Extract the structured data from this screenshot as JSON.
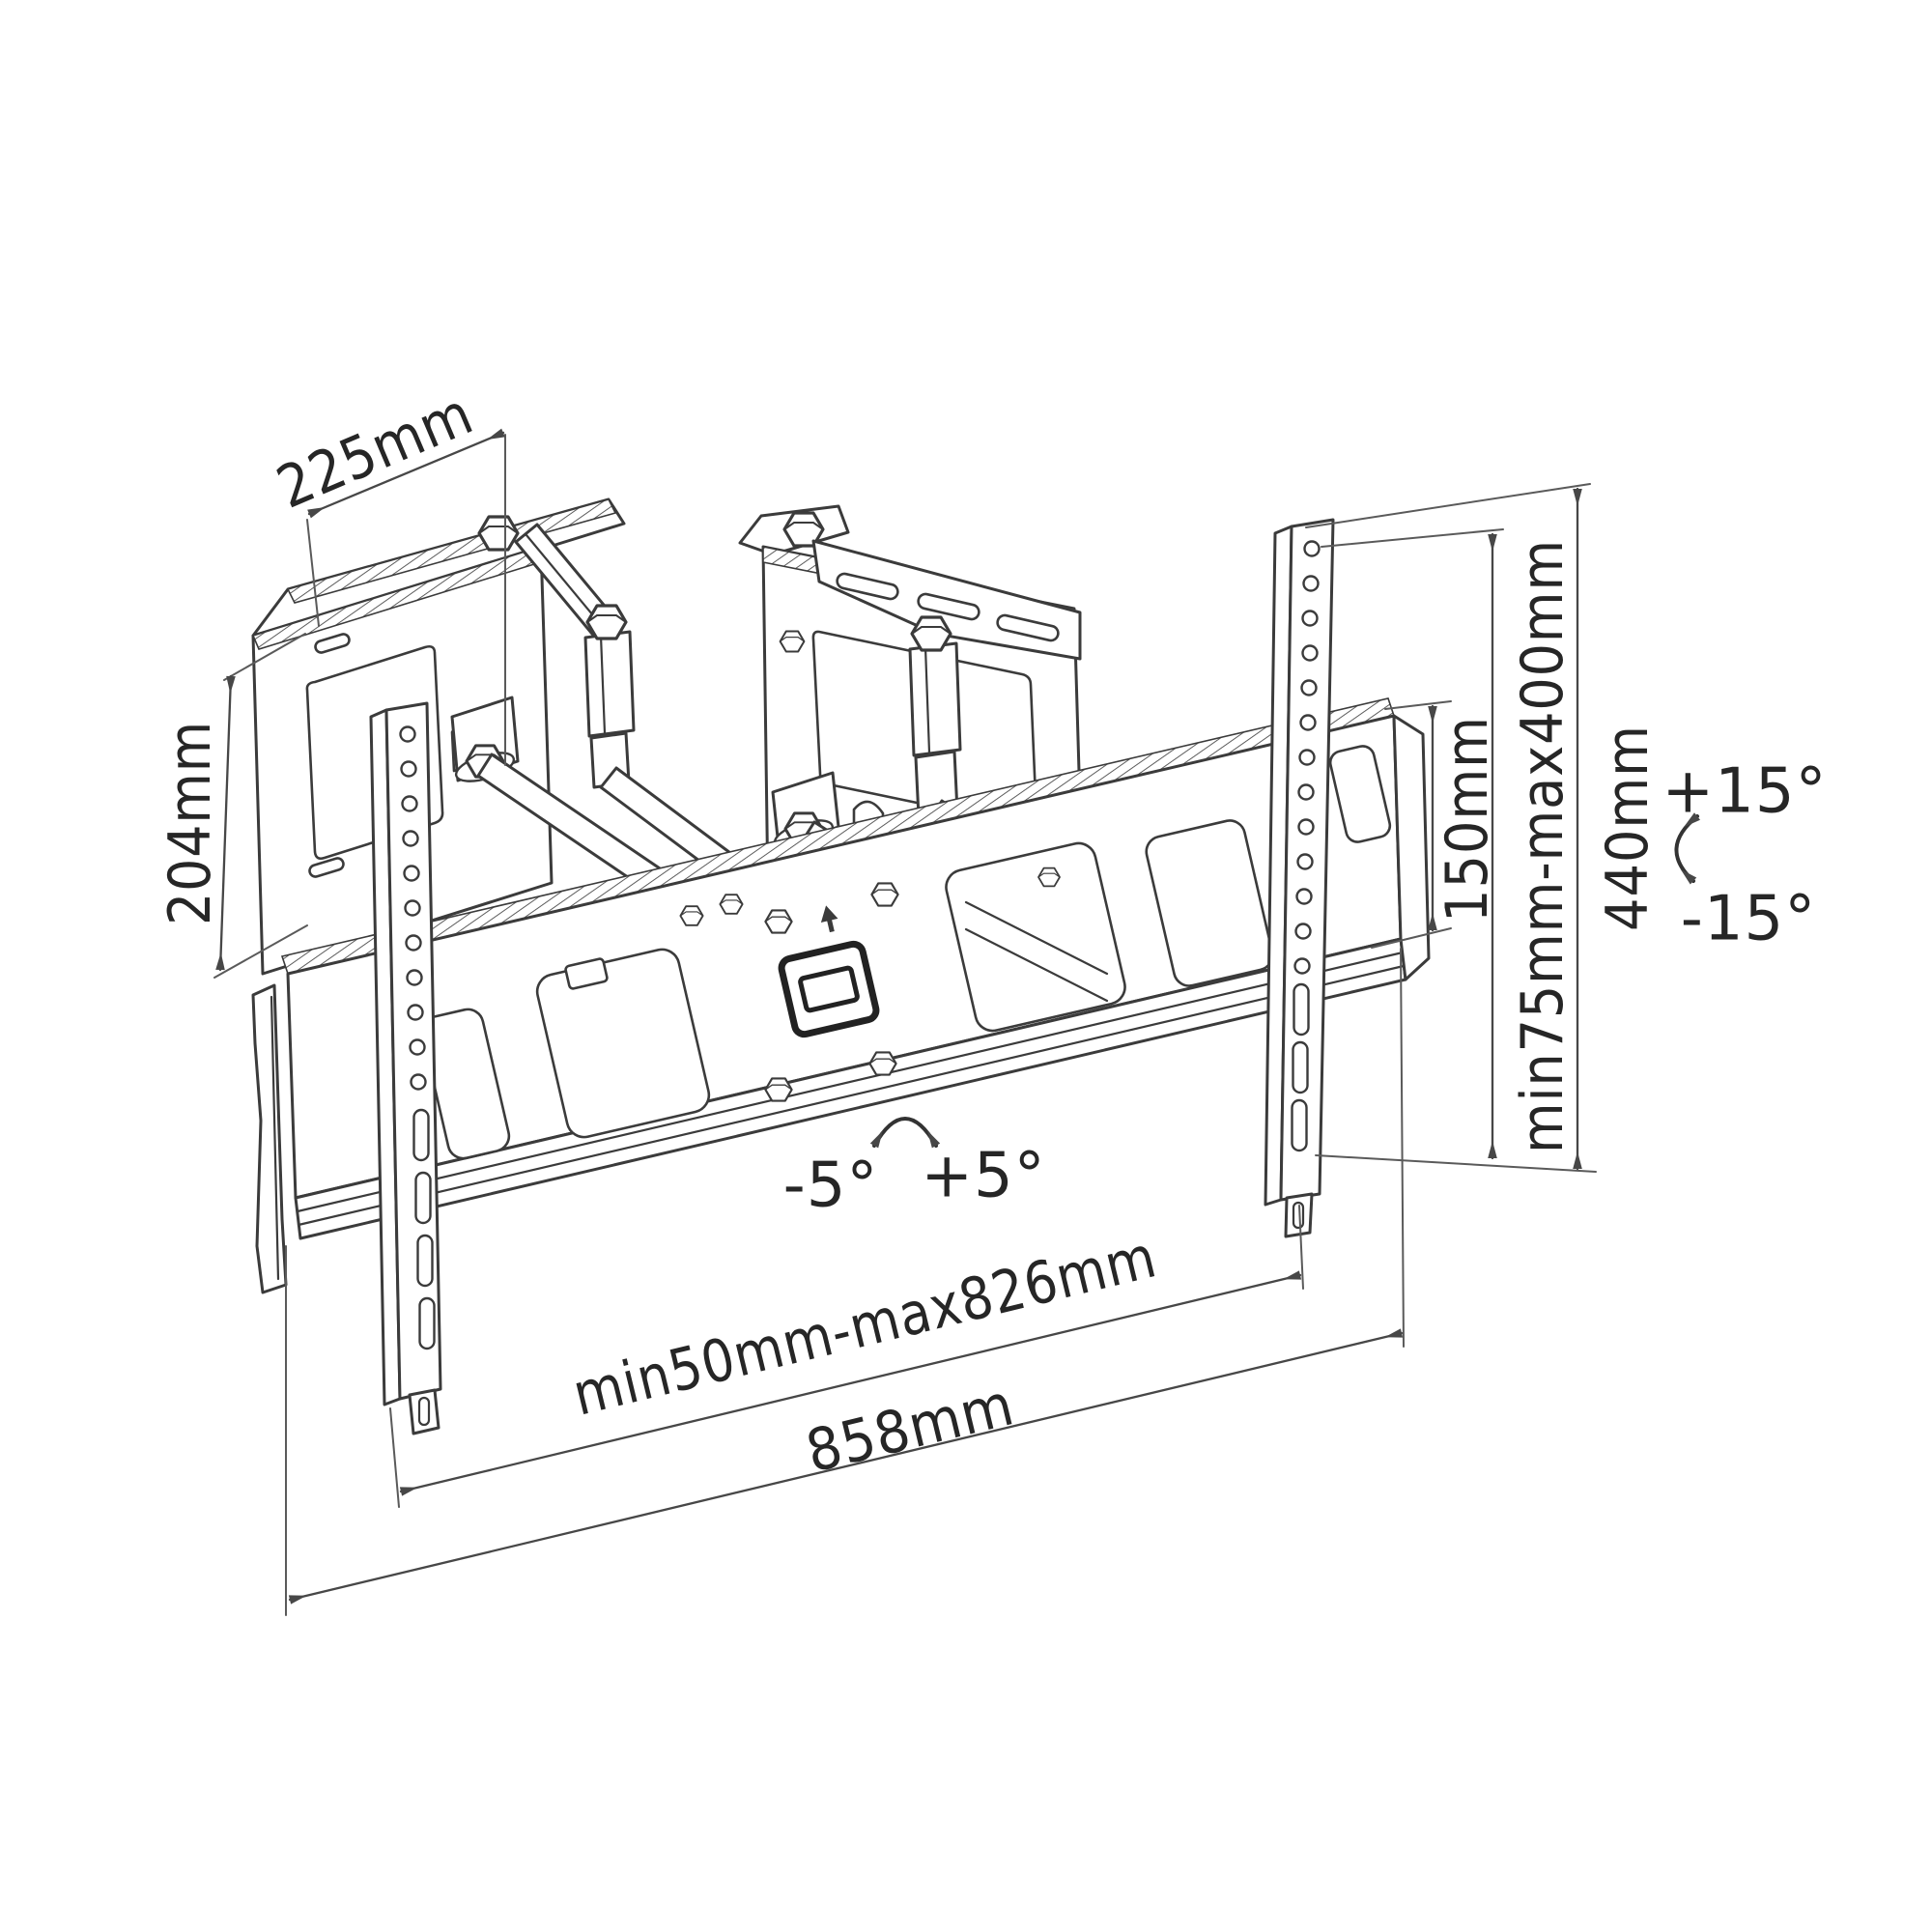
{
  "diagram": {
    "type": "technical-line-drawing",
    "subject": "Articulating full-motion TV wall mount bracket - dimensional diagram",
    "background_color": "#ffffff",
    "line_color": "#3b3b3b",
    "dimension_line_color": "#474747",
    "text_color": "#262626",
    "labels": {
      "flange_width": "225mm",
      "wall_plate_height": "204mm",
      "bracket_bar_height": "150mm",
      "vesa_vertical_range": "min75mm-max400mm",
      "rail_height": "440mm",
      "tilt_up": "+15°",
      "tilt_down": "-15°",
      "swivel_left": "-5°",
      "swivel_right": "+5°",
      "hole_span_range": "min50mm-max826mm",
      "bar_width": "858mm"
    },
    "icons": {
      "tilt": "tilt-range-arrow-icon",
      "swivel": "swivel-range-arrow-icon"
    }
  }
}
